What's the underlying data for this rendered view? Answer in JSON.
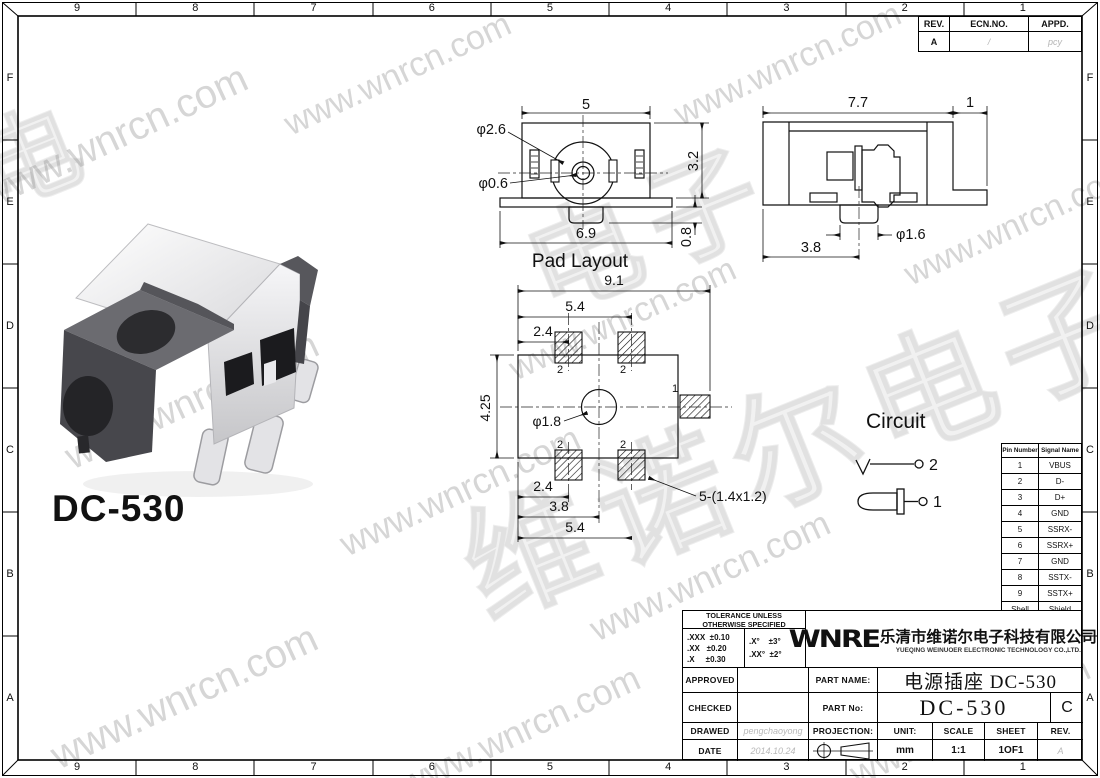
{
  "frame": {
    "top_ruler": [
      "9",
      "8",
      "7",
      "6",
      "5",
      "4",
      "3",
      "2",
      "1"
    ],
    "bottom_ruler": [
      "9",
      "8",
      "7",
      "6",
      "5",
      "4",
      "3",
      "2",
      "1"
    ],
    "left_ruler": [
      "F",
      "E",
      "D",
      "C",
      "B",
      "A"
    ],
    "right_ruler": [
      "F",
      "E",
      "D",
      "C",
      "B",
      "A"
    ]
  },
  "rev_table": {
    "headers": [
      "REV.",
      "ECN.NO.",
      "APPD."
    ],
    "values": [
      "A",
      "/",
      "pcy"
    ]
  },
  "product": {
    "label": "DC-530"
  },
  "watermark": {
    "url_text": "www.wnrcn.com",
    "cn_large": "维诺尔电子",
    "cn_small": "电子",
    "cn_corner": "电",
    "gray": "#d6d6d6"
  },
  "front_view": {
    "title": "Pad Layout",
    "dims": {
      "top_width": "5",
      "hole_outer": "φ2.6",
      "hole_inner": "φ0.6",
      "height": "3.2",
      "bottom_width": "6.9",
      "tab_height": "0.8"
    }
  },
  "side_view": {
    "dims": {
      "top_width": "7.7",
      "flange": "1",
      "pin_offset": "3.8",
      "pin_dia": "φ1.6"
    }
  },
  "pad_layout": {
    "dims": {
      "overall": "9.1",
      "span_top": "5.4",
      "offset_top": "2.4",
      "height": "4.25",
      "hole": "φ1.8",
      "offset_bottom": "2.4",
      "center_offset": "3.8",
      "span_bottom": "5.4",
      "pad_note": "5-(1.4x1.2)",
      "pad2": "2",
      "pad1": "1"
    }
  },
  "circuit": {
    "title": "Circuit",
    "pin2": "2",
    "pin1": "1"
  },
  "pin_table": {
    "headers": [
      "Pin Number",
      "Signal Name"
    ],
    "rows": [
      [
        "1",
        "VBUS"
      ],
      [
        "2",
        "D-"
      ],
      [
        "3",
        "D+"
      ],
      [
        "4",
        "GND"
      ],
      [
        "5",
        "SSRX-"
      ],
      [
        "6",
        "SSRX+"
      ],
      [
        "7",
        "GND"
      ],
      [
        "8",
        "SSTX-"
      ],
      [
        "9",
        "SSTX+"
      ],
      [
        "Shell",
        "Shield"
      ]
    ]
  },
  "title_block": {
    "tolerance": {
      "header": "TOLERANCE UNLESS\nOTHERWISE SPECIFIED",
      "left": ".XXX  ±0.10\n.XX   ±0.20\n.X     ±0.30",
      "right": ".X°    ±3°\n.XX°  ±2°"
    },
    "company": {
      "logo": "WNRE",
      "name_cn": "乐清市维诺尔电子科技有限公司",
      "name_en": "YUEQING WEINUOER ELECTRONIC TECHNOLOGY CO.,LTD."
    },
    "labels": {
      "approved": "APPROVED",
      "checked": "CHECKED",
      "drawed": "DRAWED",
      "date": "DATE",
      "part_name": "PART NAME:",
      "part_no": "PART No:",
      "projection": "PROJECTION:",
      "unit": "UNIT:",
      "scale": "SCALE",
      "sheet": "SHEET",
      "rev": "REV."
    },
    "values": {
      "part_name": "电源插座 DC-530",
      "part_no": "DC-530",
      "part_no_rev": "C",
      "drawed_by": "pengchaoyong",
      "date": "2014.10.24",
      "unit": "mm",
      "scale": "1:1",
      "sheet": "1OF1",
      "rev": "A"
    }
  }
}
